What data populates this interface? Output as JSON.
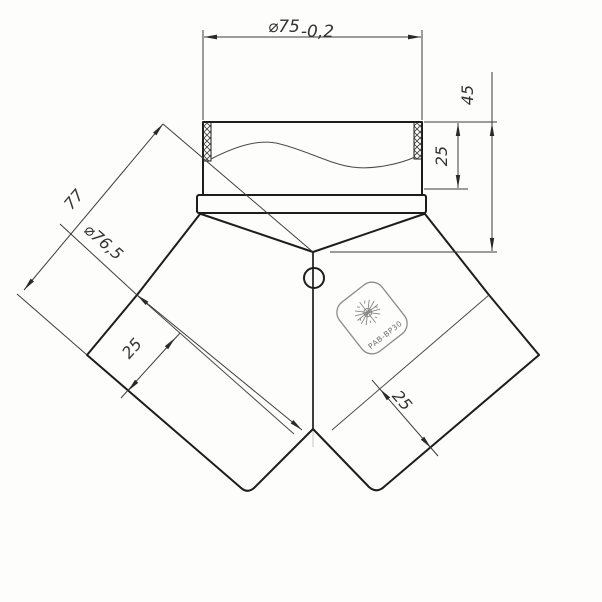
{
  "drawing": {
    "type": "technical-drawing",
    "subject": "Y-branch duct fitting (wye), front view",
    "background": "#fdfdfb",
    "outline_color": "#1d1d1d",
    "dimension_color": "#3c3c3c",
    "dimensions": {
      "top_diameter": {
        "value": "⌀75",
        "tolerance": "-0,2"
      },
      "collar_crimp_depth": "25",
      "collar_total_height": "45",
      "branch_length": "77",
      "branch_diameter": "⌀76,5",
      "left_branch_crimp": "25",
      "right_branch_crimp": "25"
    },
    "stamp": {
      "text": "РАВ-ВР30"
    }
  }
}
